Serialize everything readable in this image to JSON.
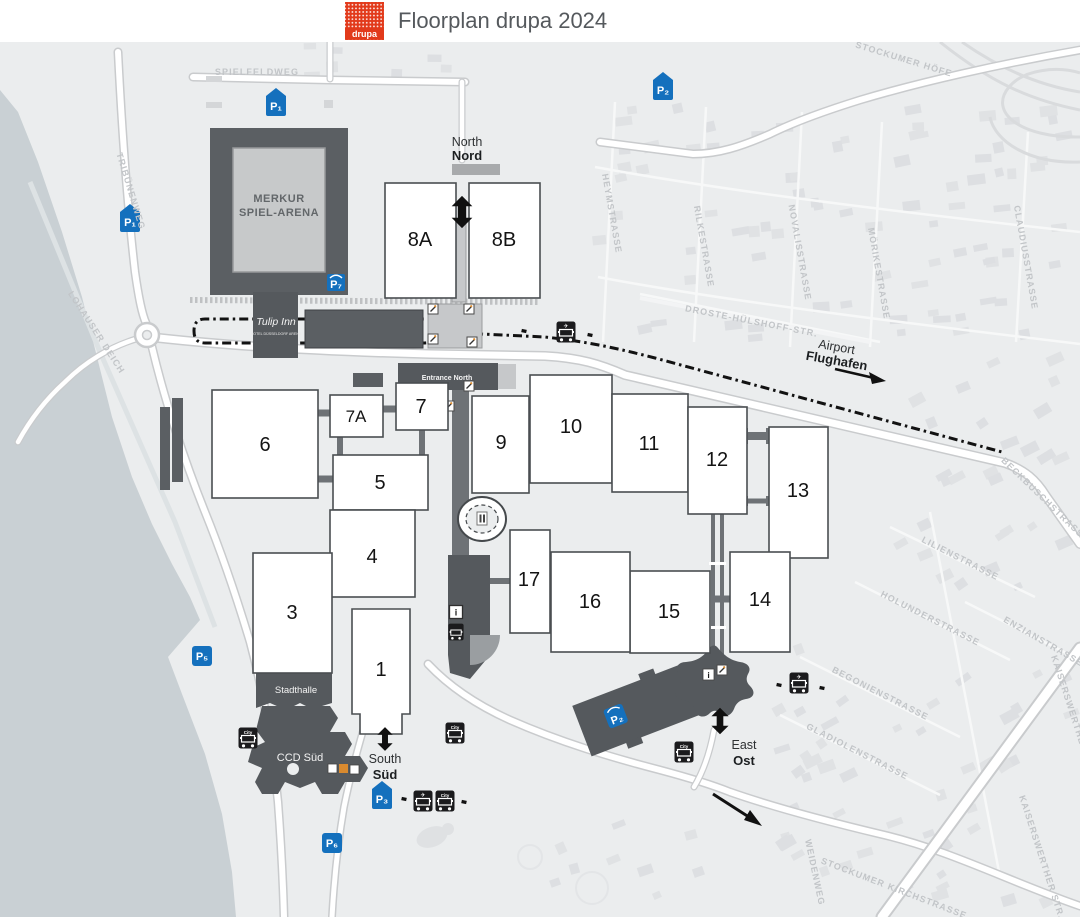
{
  "header": {
    "title": "Floorplan drupa 2024",
    "logo": "drupa"
  },
  "halls": {
    "h1": "1",
    "h3": "3",
    "h4": "4",
    "h5": "5",
    "h6": "6",
    "h7": "7",
    "h7a": "7A",
    "h8a": "8A",
    "h8b": "8B",
    "h9": "9",
    "h10": "10",
    "h11": "11",
    "h12": "12",
    "h13": "13",
    "h14": "14",
    "h15": "15",
    "h16": "16",
    "h17": "17"
  },
  "buildings": {
    "arena_line1": "MERKUR",
    "arena_line2": "SPIEL-ARENA",
    "hotel_name": "Tulip Inn",
    "hotel_sub": "HOTEL DÜSSELDORF ARENA",
    "stadthalle": "Stadthalle",
    "ccd": "CCD Süd"
  },
  "entrances": {
    "north_en": "North",
    "north_de": "Nord",
    "south_en": "South",
    "south_de": "Süd",
    "east_en": "East",
    "east_de": "Ost",
    "entrance_north": "Entrance North"
  },
  "airport": {
    "en": "Airport",
    "de": "Flughafen"
  },
  "parking": {
    "p1a": "P₁",
    "p1b": "P₁",
    "p2": "P₂",
    "p3": "P₃",
    "p5": "P₅",
    "p6": "P₆",
    "p7": "P₇",
    "garage": "P₂"
  },
  "transit": {
    "city": "City"
  },
  "icons": {
    "info": "i",
    "plane": "✈"
  },
  "streets": {
    "spielfeldweg": "SPIELFELDWEG",
    "tribuenenweg": "TRIBÜNENWEG",
    "lohauser_deich": "LOHAUSER DEICH",
    "stockumer_hoefe": "STOCKUMER HÖFE",
    "heymstrasse": "HEYMSTRASSE",
    "rilkestrasse": "RILKESTRASSE",
    "novalisstrasse": "NOVALISSTRASSE",
    "moerikestrasse": "MÖRIKESTRASSE",
    "claudiusstrasse": "CLAUDIUSSTRASSE",
    "droste": "DROSTE-HÜLSHOFF-STR.",
    "beckbuschstrasse": "BECKBUSCHSTRASSE",
    "lilienstrasse": "LILIENSTRASSE",
    "holunderstrasse": "HOLUNDERSTRASSE",
    "enzianstrasse": "ENZIANSTRASSE",
    "begonienstrasse": "BEGONIENSTRASSE",
    "gladiolenstrasse": "GLADIOLENSTRASSE",
    "stockumer_kirchstrasse": "STOCKUMER KIRCHSTRASSE",
    "kaiserswerther_a": "KAISERSWERTHER STR.",
    "kaiserswerther_b": "KAISERSWERTHER STR.",
    "weidenweg": "WEIDENWEG"
  },
  "colors": {
    "accent_red": "#e23a1b",
    "parking_blue": "#1470bd",
    "map_bg": "#ebedee",
    "water": "#c9d0d4",
    "building_dark": "#5b5f63"
  }
}
